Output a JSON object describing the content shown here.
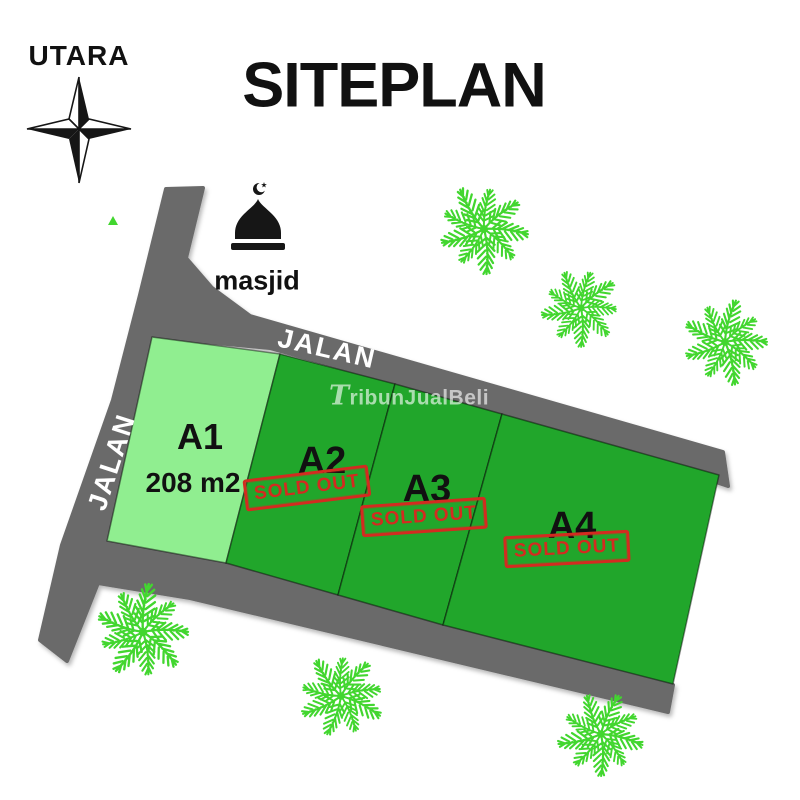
{
  "header": {
    "north_label": "UTARA",
    "title": "SITEPLAN"
  },
  "landmarks": {
    "mosque_label": "masjid"
  },
  "roads": {
    "top_label": "JALAN",
    "left_label": "JALAN"
  },
  "watermark": {
    "text": "TribunJualBeli"
  },
  "plots": [
    {
      "id": "A1",
      "area": "208 m2",
      "status": "available",
      "color": "#90EE90"
    },
    {
      "id": "A2",
      "status": "SOLD OUT",
      "color": "#21A62B"
    },
    {
      "id": "A3",
      "status": "SOLD OUT",
      "color": "#21A62B"
    },
    {
      "id": "A4",
      "status": "SOLD OUT",
      "color": "#21A62B"
    }
  ],
  "colors": {
    "road": "#6B6B6B",
    "plot_available": "#90EE90",
    "plot_sold": "#21A62B",
    "palm": "#42D62F",
    "stamp_red": "#D32B20",
    "ink": "#161616"
  }
}
